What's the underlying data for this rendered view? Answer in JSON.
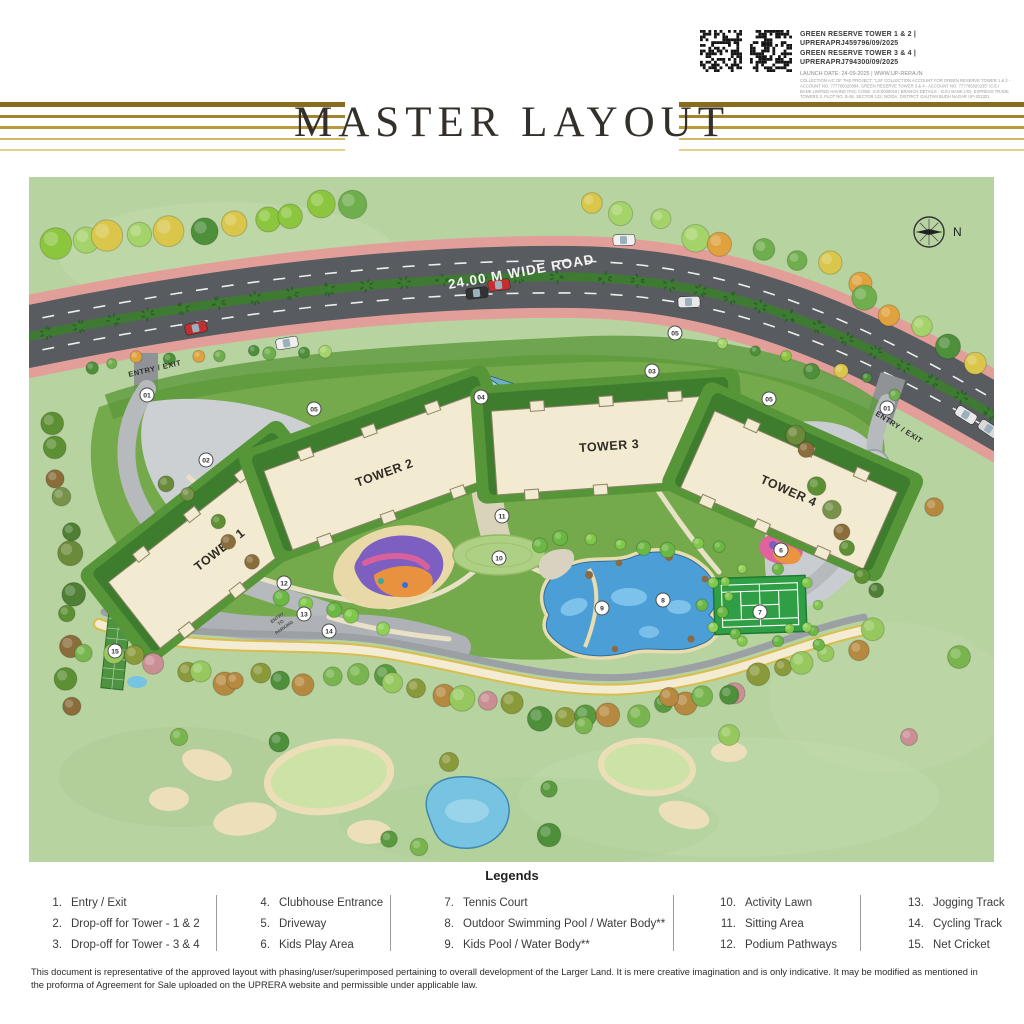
{
  "colors": {
    "gold_accent": "#b08d33",
    "title_color": "#33302b",
    "road_label_color": "#f4f4f4"
  },
  "rera": {
    "line1": "GREEN RESERVE TOWER 1 & 2 | UPRERAPRJ459796/09/2025",
    "line2": "GREEN RESERVE TOWER 3 & 4 | UPRERAPRJ794300/09/2025",
    "launch": "LAUNCH DATE: 24-09-2025 | WWW.UP-RERA.IN",
    "fine_print": "COLLECTION A/C OF THE PROJECT: \"LSF COLLECTION ACCOUNT FOR GREEN RESERVE TOWER 1 & 2 - ACCOUNT NO. 777705020894, GREEN RESERVE TOWER 3 & 4 - ACCOUNT NO. 777705020235\" ICICI BANK LIMITED HAVING IFSC CODE: ICIC0000019 | BRANCH DETAILS - ICICI BANK LTD, EXPRESS TRADE TOWERS 2, PLOT NO. B-36, SECTOR 132, NOIDA, DISTRICT GAUTAM BUDH NAGAR UP-201301"
  },
  "title": "MASTER LAYOUT",
  "map": {
    "road_label": "24.00 M WIDE ROAD",
    "entry_exit_left": "ENTRY / EXIT",
    "entry_exit_right": "ENTRY / EXIT",
    "entry_to_parking": [
      "ENTRY",
      "TO",
      "PARKING"
    ],
    "compass_label": "N",
    "towers": [
      {
        "label": "TOWER 1",
        "x": 190,
        "y": 372,
        "rot": -38,
        "w": 215,
        "h": 84
      },
      {
        "label": "TOWER 2",
        "x": 355,
        "y": 295,
        "rot": -20,
        "w": 225,
        "h": 84
      },
      {
        "label": "TOWER 3",
        "x": 580,
        "y": 268,
        "rot": -4,
        "w": 230,
        "h": 84
      },
      {
        "label": "TOWER 4",
        "x": 760,
        "y": 313,
        "rot": 24,
        "w": 200,
        "h": 84
      }
    ],
    "markers": [
      {
        "n": "01",
        "x": 118,
        "y": 218
      },
      {
        "n": "02",
        "x": 177,
        "y": 283
      },
      {
        "n": "05",
        "x": 285,
        "y": 232
      },
      {
        "n": "03",
        "x": 623,
        "y": 194
      },
      {
        "n": "05",
        "x": 646,
        "y": 156
      },
      {
        "n": "05",
        "x": 740,
        "y": 222
      },
      {
        "n": "01",
        "x": 858,
        "y": 231
      },
      {
        "n": "04",
        "x": 452,
        "y": 220
      },
      {
        "n": "11",
        "x": 473,
        "y": 339
      },
      {
        "n": "10",
        "x": 470,
        "y": 381
      },
      {
        "n": "12",
        "x": 255,
        "y": 406
      },
      {
        "n": "13",
        "x": 275,
        "y": 437
      },
      {
        "n": "14",
        "x": 300,
        "y": 454
      },
      {
        "n": "15",
        "x": 86,
        "y": 474
      },
      {
        "n": "9",
        "x": 573,
        "y": 431
      },
      {
        "n": "8",
        "x": 634,
        "y": 423
      },
      {
        "n": "7",
        "x": 731,
        "y": 435
      },
      {
        "n": "6",
        "x": 752,
        "y": 373
      }
    ]
  },
  "legend": {
    "title": "Legends",
    "columns": [
      [
        {
          "n": "1.",
          "label": "Entry / Exit"
        },
        {
          "n": "2.",
          "label": "Drop-off for Tower - 1 & 2"
        },
        {
          "n": "3.",
          "label": "Drop-off for Tower - 3 & 4"
        }
      ],
      [
        {
          "n": "4.",
          "label": "Clubhouse Entrance"
        },
        {
          "n": "5.",
          "label": "Driveway"
        },
        {
          "n": "6.",
          "label": "Kids Play Area"
        }
      ],
      [
        {
          "n": "7.",
          "label": "Tennis Court"
        },
        {
          "n": "8.",
          "label": "Outdoor Swimming Pool / Water Body**"
        },
        {
          "n": "9.",
          "label": "Kids Pool / Water Body**"
        }
      ],
      [
        {
          "n": "10.",
          "label": "Activity Lawn"
        },
        {
          "n": "11.",
          "label": "Sitting Area"
        },
        {
          "n": "12.",
          "label": "Podium Pathways"
        }
      ],
      [
        {
          "n": "13.",
          "label": "Jogging Track"
        },
        {
          "n": "14.",
          "label": "Cycling Track"
        },
        {
          "n": "15.",
          "label": "Net Cricket"
        }
      ]
    ]
  },
  "disclaimer": "This document is representative of the approved layout with phasing/user/superimposed pertaining to overall development of the Larger Land. It is mere creative imagination and is only indicative. It may be modified as mentioned in the proforma of Agreement for Sale uploaded on the UPRERA website and permissible under applicable law."
}
